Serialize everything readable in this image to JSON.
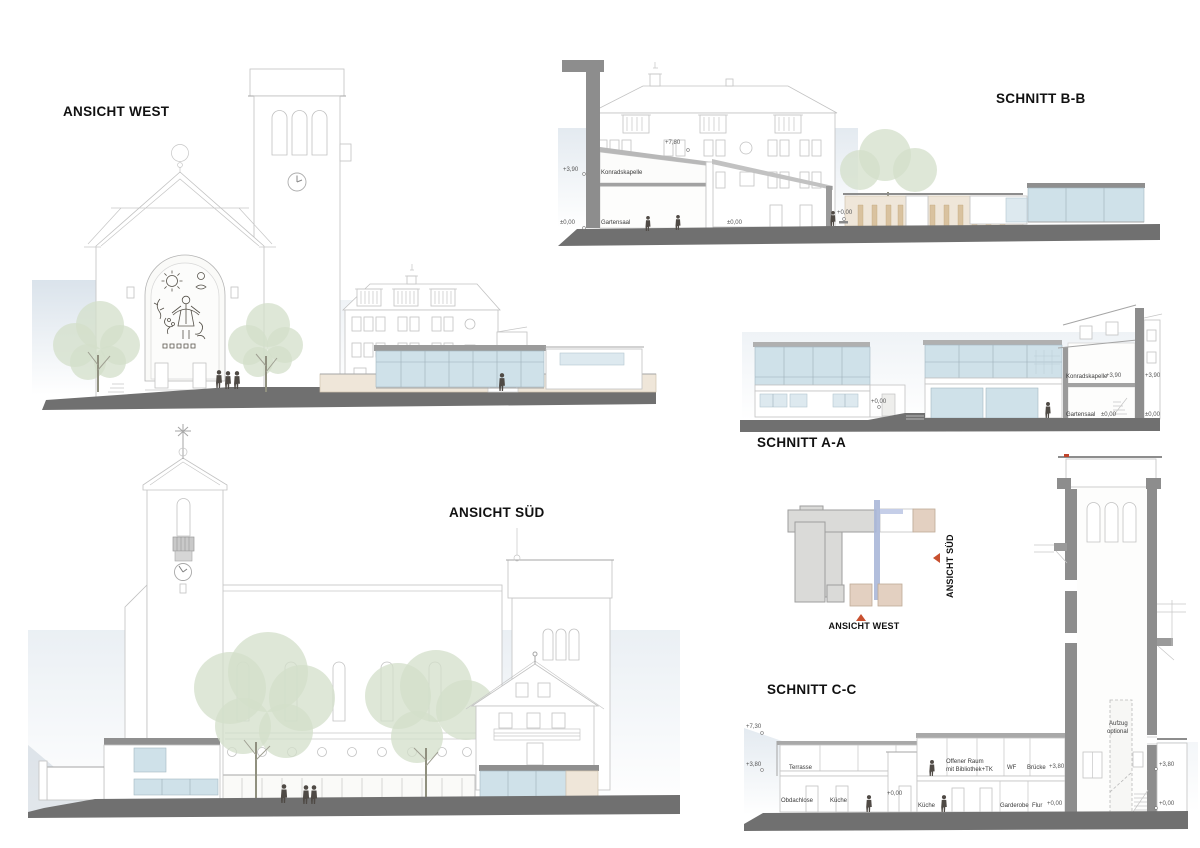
{
  "sheet": {
    "width": 1200,
    "height": 848
  },
  "colors": {
    "paper": "#ffffff",
    "line_light": "#c6c6c6",
    "line_mid": "#9c9c9c",
    "wall_cut": "#8d8d8d",
    "ground": "#707070",
    "glass": "#cfe1e9",
    "glass_light": "#dde9ef",
    "beige": "#efe6d9",
    "timber": "#d9c29f",
    "tree_green": "#d3dfca",
    "accent_red": "#c0442c",
    "section_blue": "#aab7d8",
    "sky": "#c7d4e0"
  },
  "ansicht_west": {
    "title": "ANSICHT WEST"
  },
  "schnitt_bb": {
    "title": "SCHNITT B-B",
    "room_konradskapelle": "Konradskapelle",
    "room_gartensaal": "Gartensaal",
    "level_roof": "+7,80",
    "level_upper": "+3,90",
    "level_zero_left": "±0,00",
    "level_zero_mid": "±0,00",
    "level_zero_right": "+0,00"
  },
  "schnitt_aa": {
    "title": "SCHNITT A-A",
    "room_konradskapelle": "Konradskapelle",
    "room_gartensaal": "Gartensaal",
    "level_upper_a": "+3,90",
    "level_upper_b": "+3,90",
    "level_zero_a": "±0,00",
    "level_zero_b": "±0,00",
    "level_zero_door": "+0,00"
  },
  "ansicht_sued": {
    "title": "ANSICHT SÜD"
  },
  "site_key": {
    "west_label": "ANSICHT WEST",
    "sued_label": "ANSICHT SÜD"
  },
  "schnitt_cc": {
    "title": "SCHNITT C-C",
    "level_roof": "+7,30",
    "level_upper_left": "+3,80",
    "level_upper_bruecke": "+3,80",
    "level_upper_right": "+3,80",
    "level_zero_mid": "+0,00",
    "level_zero_flur": "+0,00",
    "level_zero_right": "+0,00",
    "room_terrasse": "Terrasse",
    "room_obdachlose": "Obdachlose",
    "room_kueche_a": "Küche",
    "room_kueche_b": "Küche",
    "room_offener_raum_line1": "Offener Raum",
    "room_offener_raum_line2": "mit Bibliothek+TK",
    "room_wf": "WF",
    "room_bruecke": "Brücke",
    "room_garderobe": "Garderobe",
    "room_flur": "Flur",
    "room_aufzug_line1": "Aufzug",
    "room_aufzug_line2": "optional"
  }
}
